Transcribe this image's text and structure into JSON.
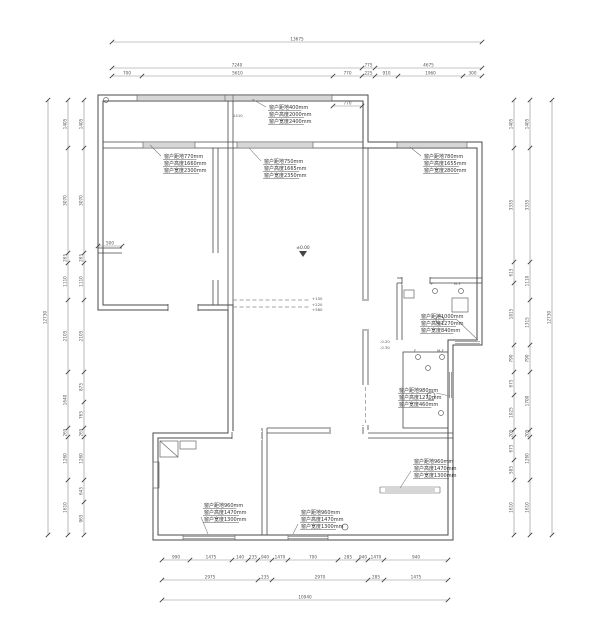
{
  "drawing": {
    "type": "residential floor plan",
    "units": "mm",
    "line_color": "#4a4a4a",
    "background": "#ffffff"
  },
  "windows": {
    "top_outer": {
      "lines": [
        "窗户距地400mm",
        "窗户高度2000mm",
        "窗户宽度2400mm"
      ]
    },
    "nw_room": {
      "lines": [
        "窗户距地770mm",
        "窗户高度1660mm",
        "窗户宽度2300mm"
      ]
    },
    "mid_room": {
      "lines": [
        "窗户距地750mm",
        "窗户高度1665mm",
        "窗户宽度2350mm"
      ]
    },
    "ne_room": {
      "lines": [
        "窗户距地780mm",
        "窗户高度1655mm",
        "窗户宽度2800mm"
      ]
    },
    "east_upper": {
      "lines": [
        "窗户距地1000mm",
        "窗户高度1270mm",
        "窗户宽度840mm"
      ]
    },
    "east_lower": {
      "lines": [
        "窗户距地980mm",
        "窗户高度1270mm",
        "窗户宽度460mm"
      ]
    },
    "se_room": {
      "lines": [
        "窗户距地960mm",
        "窗户高度1470mm",
        "窗户宽度1300mm"
      ]
    },
    "sw_room": {
      "lines": [
        "窗户距地960mm",
        "窗户高度1470mm",
        "窗户宽度1300mm"
      ]
    },
    "s_mid_room": {
      "lines": [
        "窗户距地960mm",
        "窗户高度1470mm",
        "窗户宽度1300mm"
      ]
    }
  },
  "levels": {
    "main": "±0.00",
    "floor_steps": [
      "+150",
      "+220",
      "+380"
    ],
    "corridor": [
      "-0.20",
      "-0.30"
    ]
  },
  "fixtures": {
    "f1": "F",
    "f2": "M-F"
  },
  "dims": {
    "top": {
      "row1": [
        "13675"
      ],
      "row2": [
        "7240",
        "775",
        "4675"
      ],
      "row3": [
        "700",
        "5610",
        "770",
        "225",
        "910",
        "1960",
        "300"
      ]
    },
    "bottom": {
      "row1": [
        "990",
        "1475",
        "140",
        "235",
        "940",
        "1470",
        "700",
        "285",
        "940",
        "1470",
        "940"
      ],
      "row2": [
        "2975",
        "235",
        "2970",
        "285",
        "1475"
      ],
      "row3": [
        "10940"
      ]
    },
    "left": {
      "outer": [
        "12730"
      ],
      "mid": [
        "1405",
        "3070",
        "265",
        "1110",
        "2105",
        "1640",
        "265",
        "1260",
        "1610"
      ],
      "inner": [
        "1405",
        "3070",
        "265",
        "1110",
        "2105",
        "875",
        "765",
        "265",
        "1260",
        "645",
        "965"
      ]
    },
    "right": {
      "outer": [
        "12730"
      ],
      "mid": [
        "1405",
        "3335",
        "1110",
        "1315",
        "790",
        "1700",
        "205",
        "1260",
        "1610"
      ],
      "inner": [
        "1405",
        "3335",
        "615",
        "1815",
        "790",
        "675",
        "1025",
        "205",
        "675",
        "585",
        "1610"
      ]
    },
    "misc": {
      "d770": [
        "770"
      ],
      "d500": [
        "500"
      ],
      "d2410": "2410"
    }
  }
}
